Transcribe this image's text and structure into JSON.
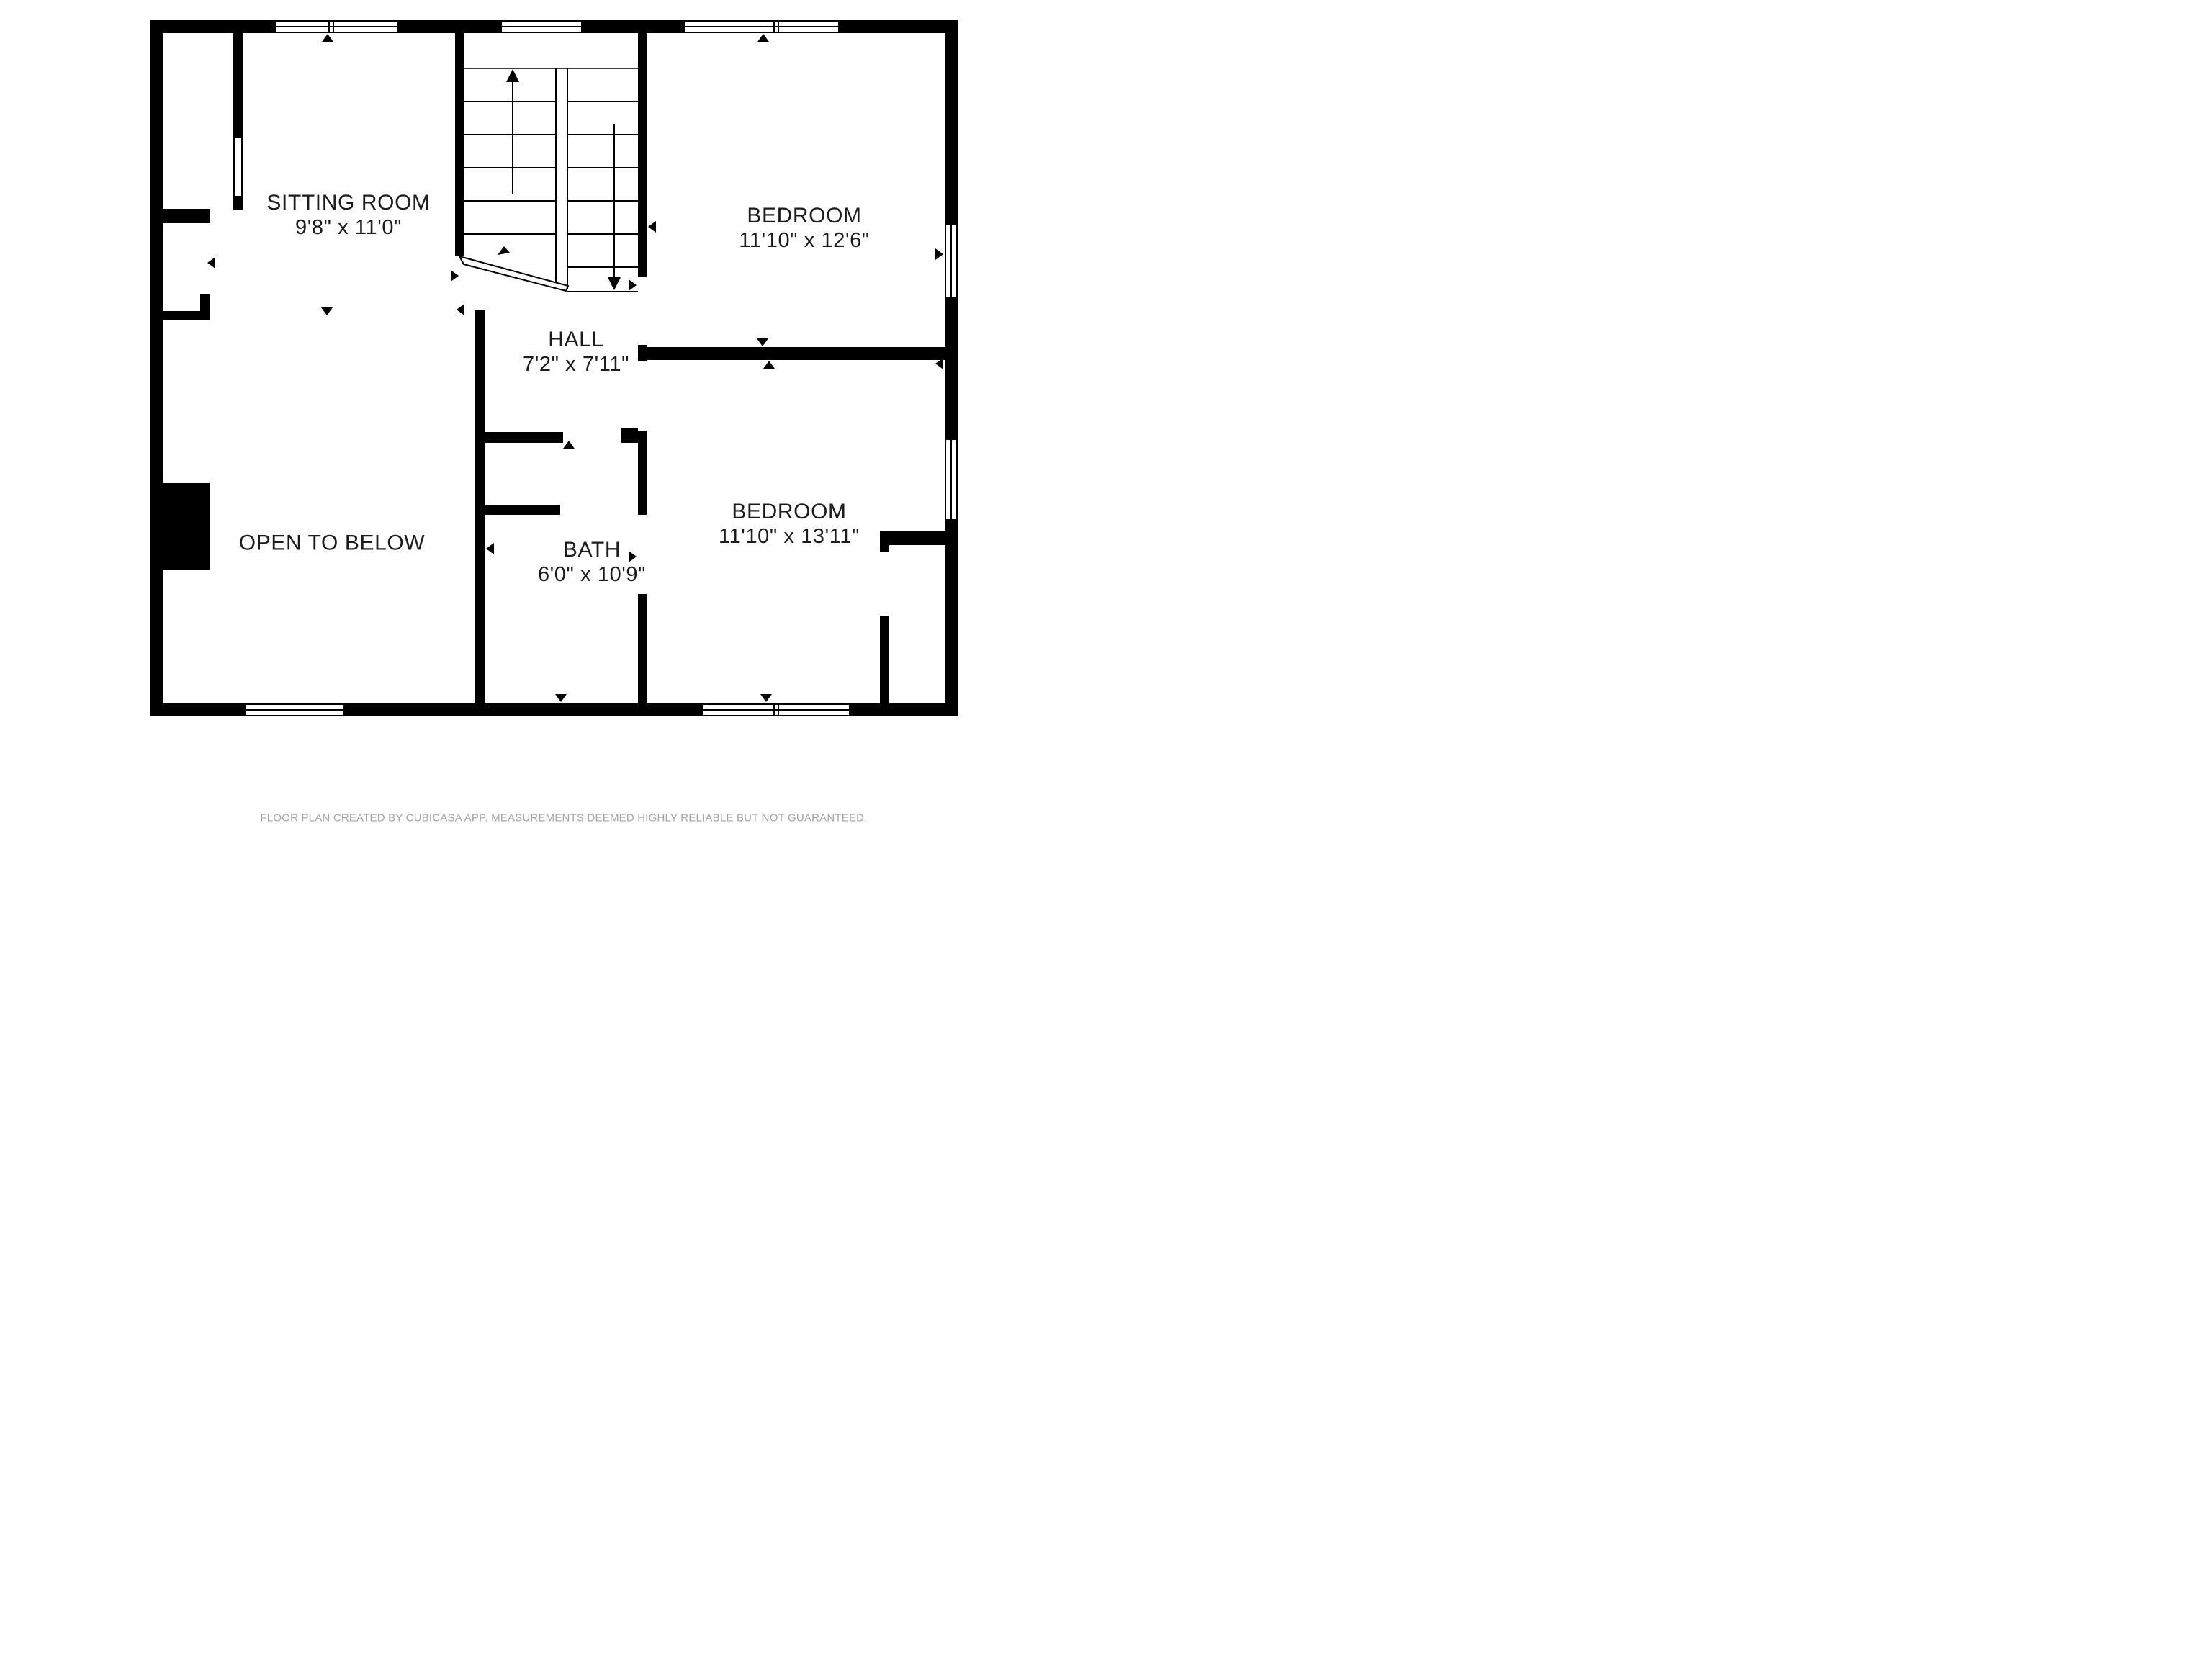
{
  "floor_plan": {
    "rooms": {
      "sitting_room": {
        "name": "SITTING ROOM",
        "dims": "9'8\" x 11'0\""
      },
      "bedroom_top": {
        "name": "BEDROOM",
        "dims": "11'10\" x 12'6\""
      },
      "hall": {
        "name": "HALL",
        "dims": "7'2\" x 7'11\""
      },
      "open_to_below": {
        "name": "OPEN TO BELOW"
      },
      "bath": {
        "name": "BATH",
        "dims": "6'0\" x 10'9\""
      },
      "bedroom_bottom": {
        "name": "BEDROOM",
        "dims": "11'10\" x 13'11\""
      }
    },
    "footer": "FLOOR PLAN CREATED BY CUBICASA APP. MEASUREMENTS DEEMED HIGHLY RELIABLE BUT NOT GUARANTEED.",
    "colors": {
      "wall": "#000000",
      "background": "#ffffff",
      "label": "#1c1c1c",
      "footer": "#a3a3a3"
    }
  }
}
